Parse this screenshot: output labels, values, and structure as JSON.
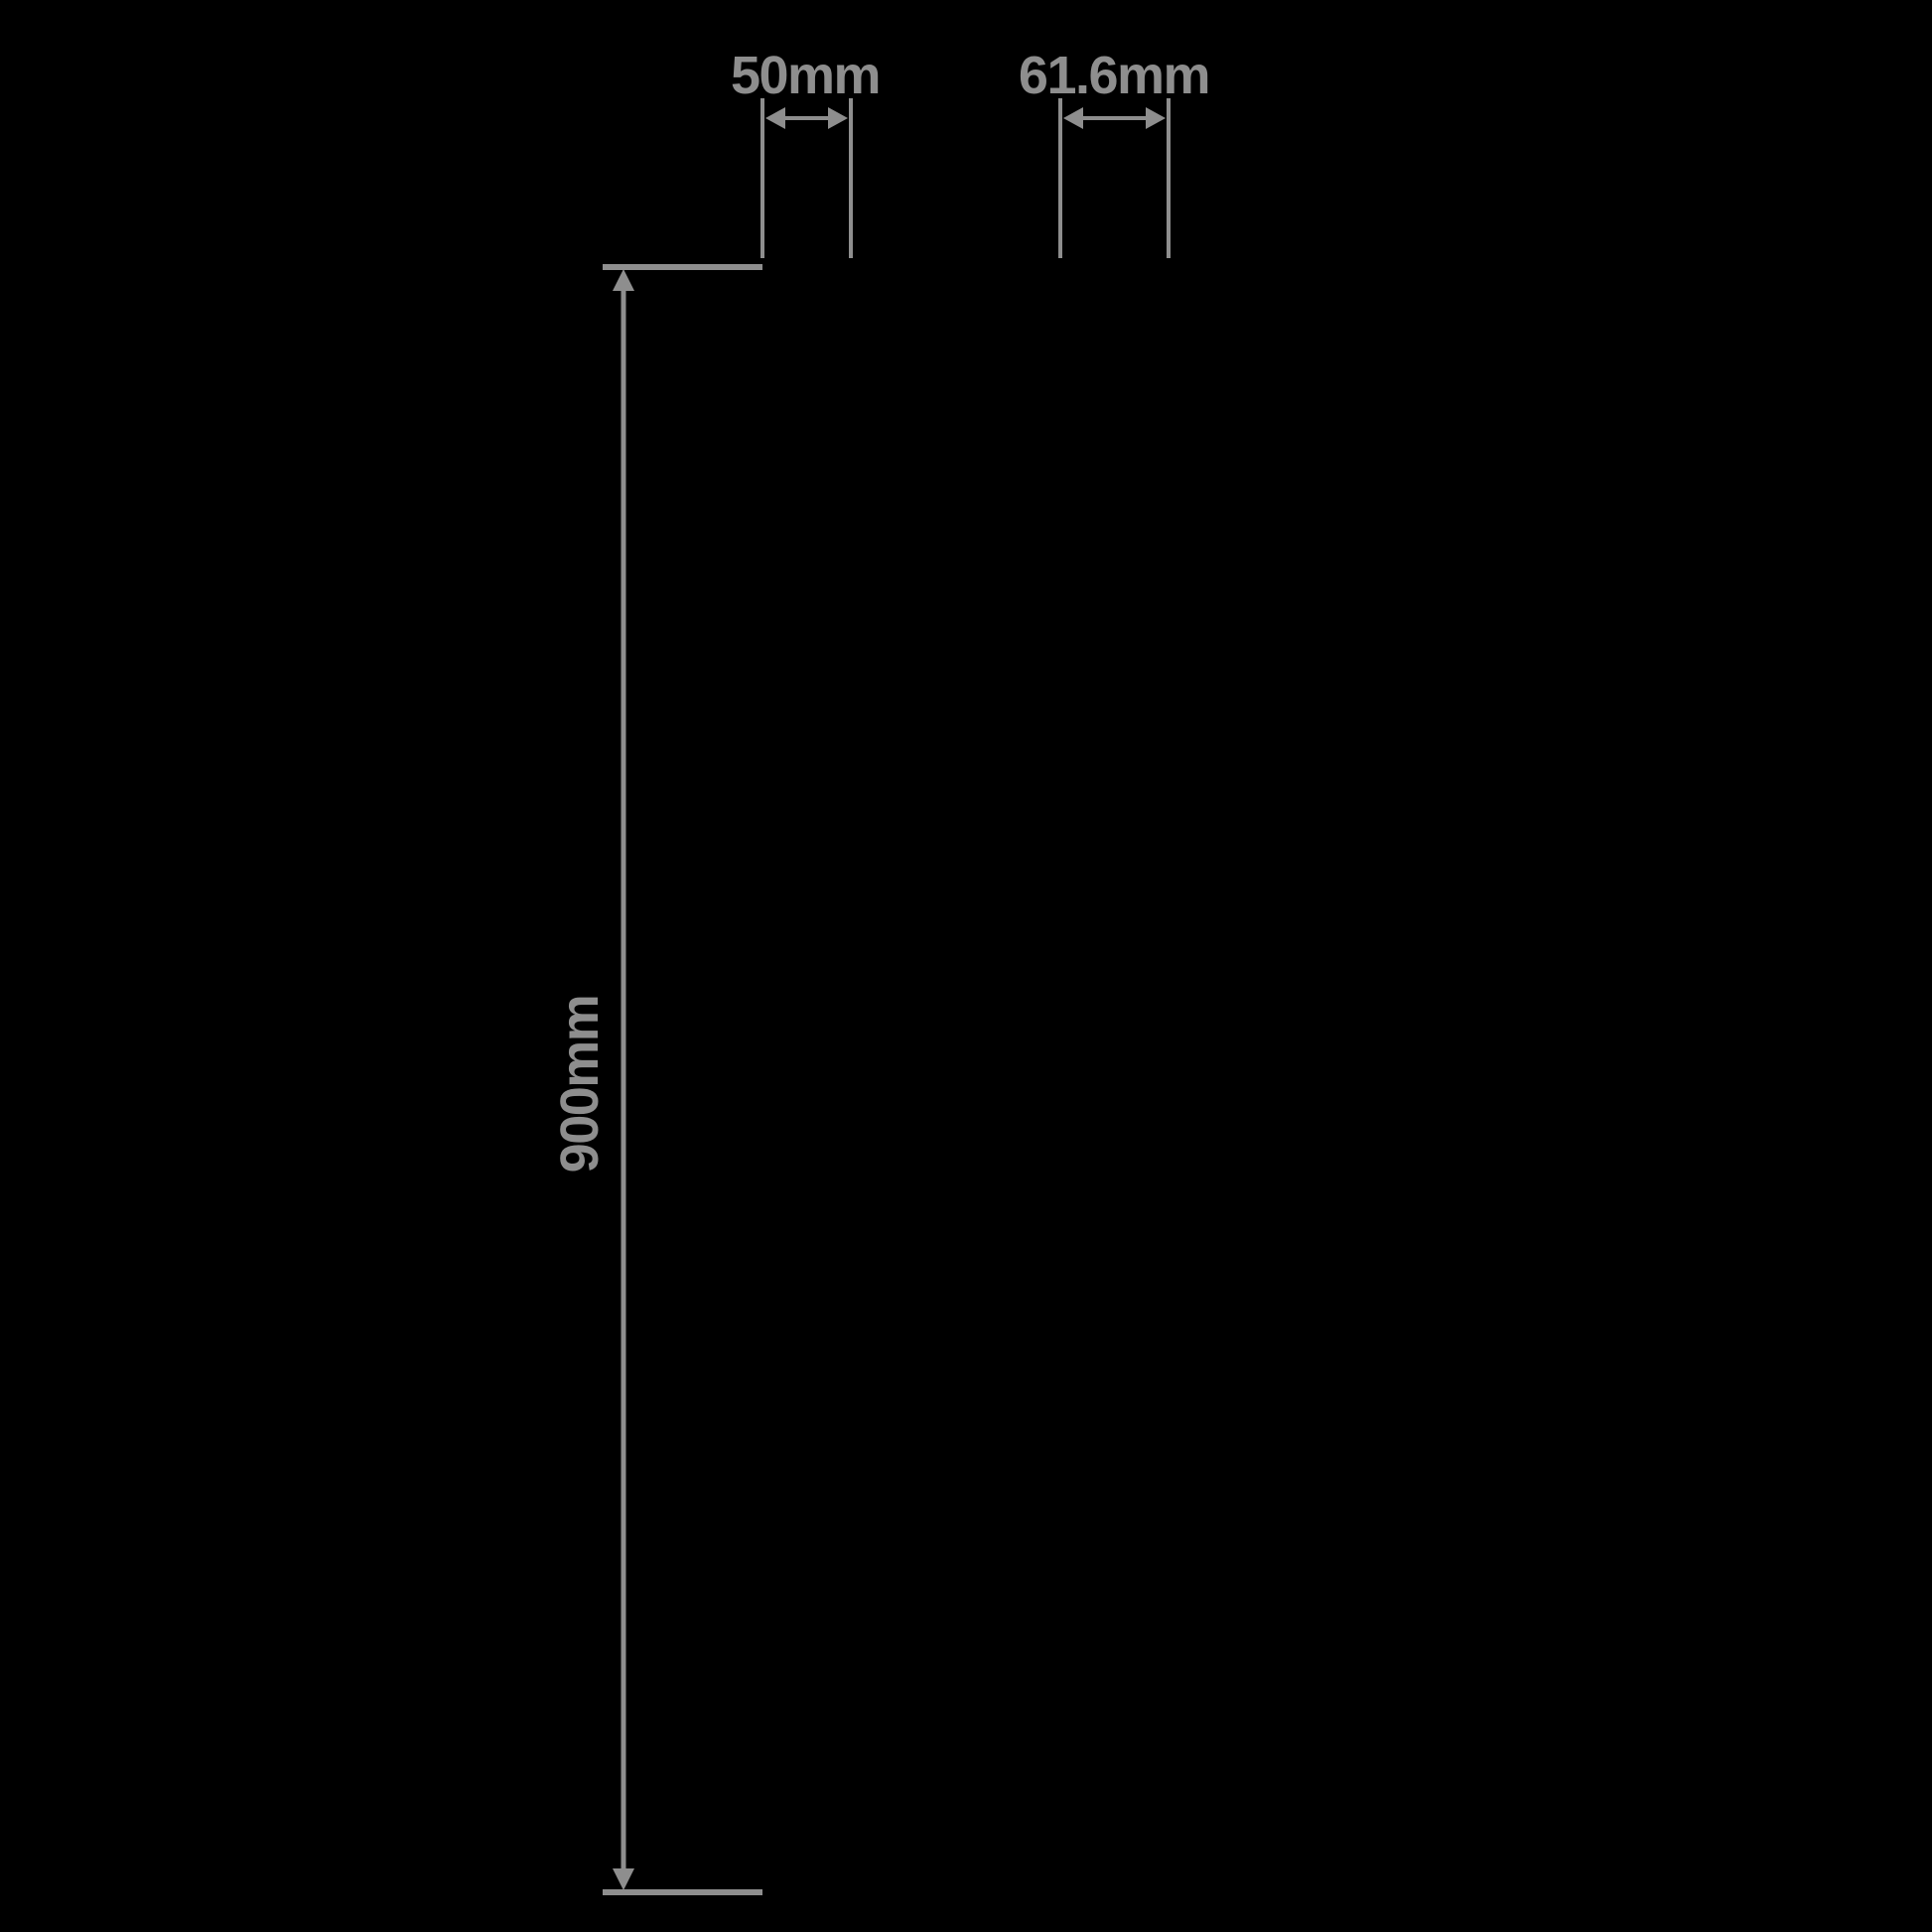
{
  "diagram": {
    "dimensions": {
      "height": {
        "label": "900mm",
        "value": 900
      },
      "width_small": {
        "label": "50mm",
        "value": 50
      },
      "width_large": {
        "label": "61.6mm",
        "value": 61.6
      }
    }
  },
  "colors": {
    "background": "#000000",
    "dimension_gray": "#8E8E8E"
  }
}
